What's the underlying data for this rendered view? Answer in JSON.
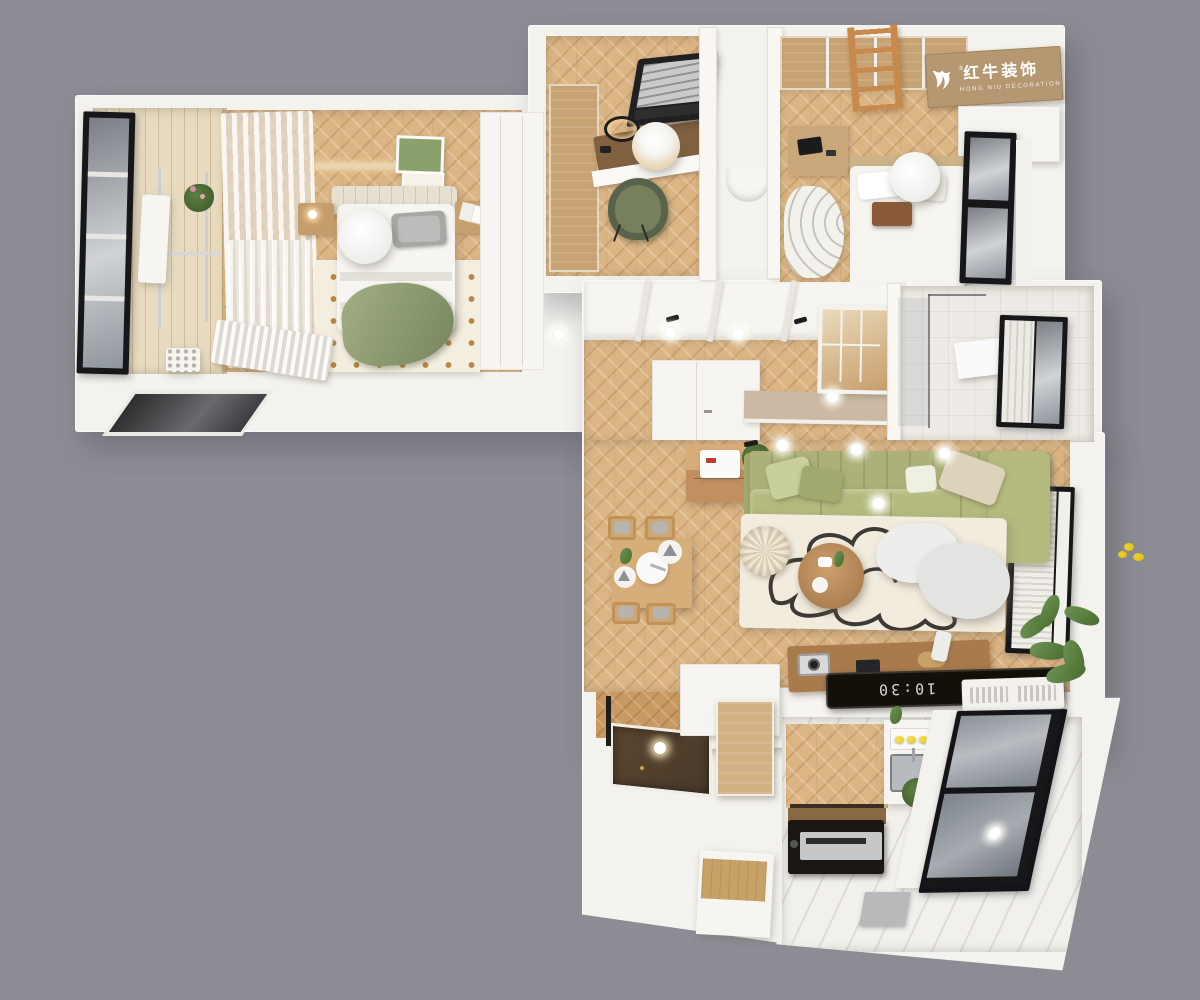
{
  "watermark": {
    "icon": "bull-logo-icon",
    "registered_mark": "®",
    "brand": "红牛装饰",
    "subtitle": "HONG NIU DECORATION"
  },
  "living_room": {
    "tv_clock": "10:30"
  },
  "colors": {
    "background": "#8c8c94",
    "wall": "#f3f2ee",
    "wood_floor": "#dcb584",
    "wood_panel": "#c7a374",
    "sofa_green": "#b4ba7e",
    "rug_cream": "#f2ecdf",
    "entry_floor_dark": "#4a3a2a",
    "window_frame": "#17171a",
    "plant_green": "#5d7f42",
    "lemon_yellow": "#e7c81f",
    "logo_board": "#b59871",
    "logo_text": "#ffffff"
  }
}
